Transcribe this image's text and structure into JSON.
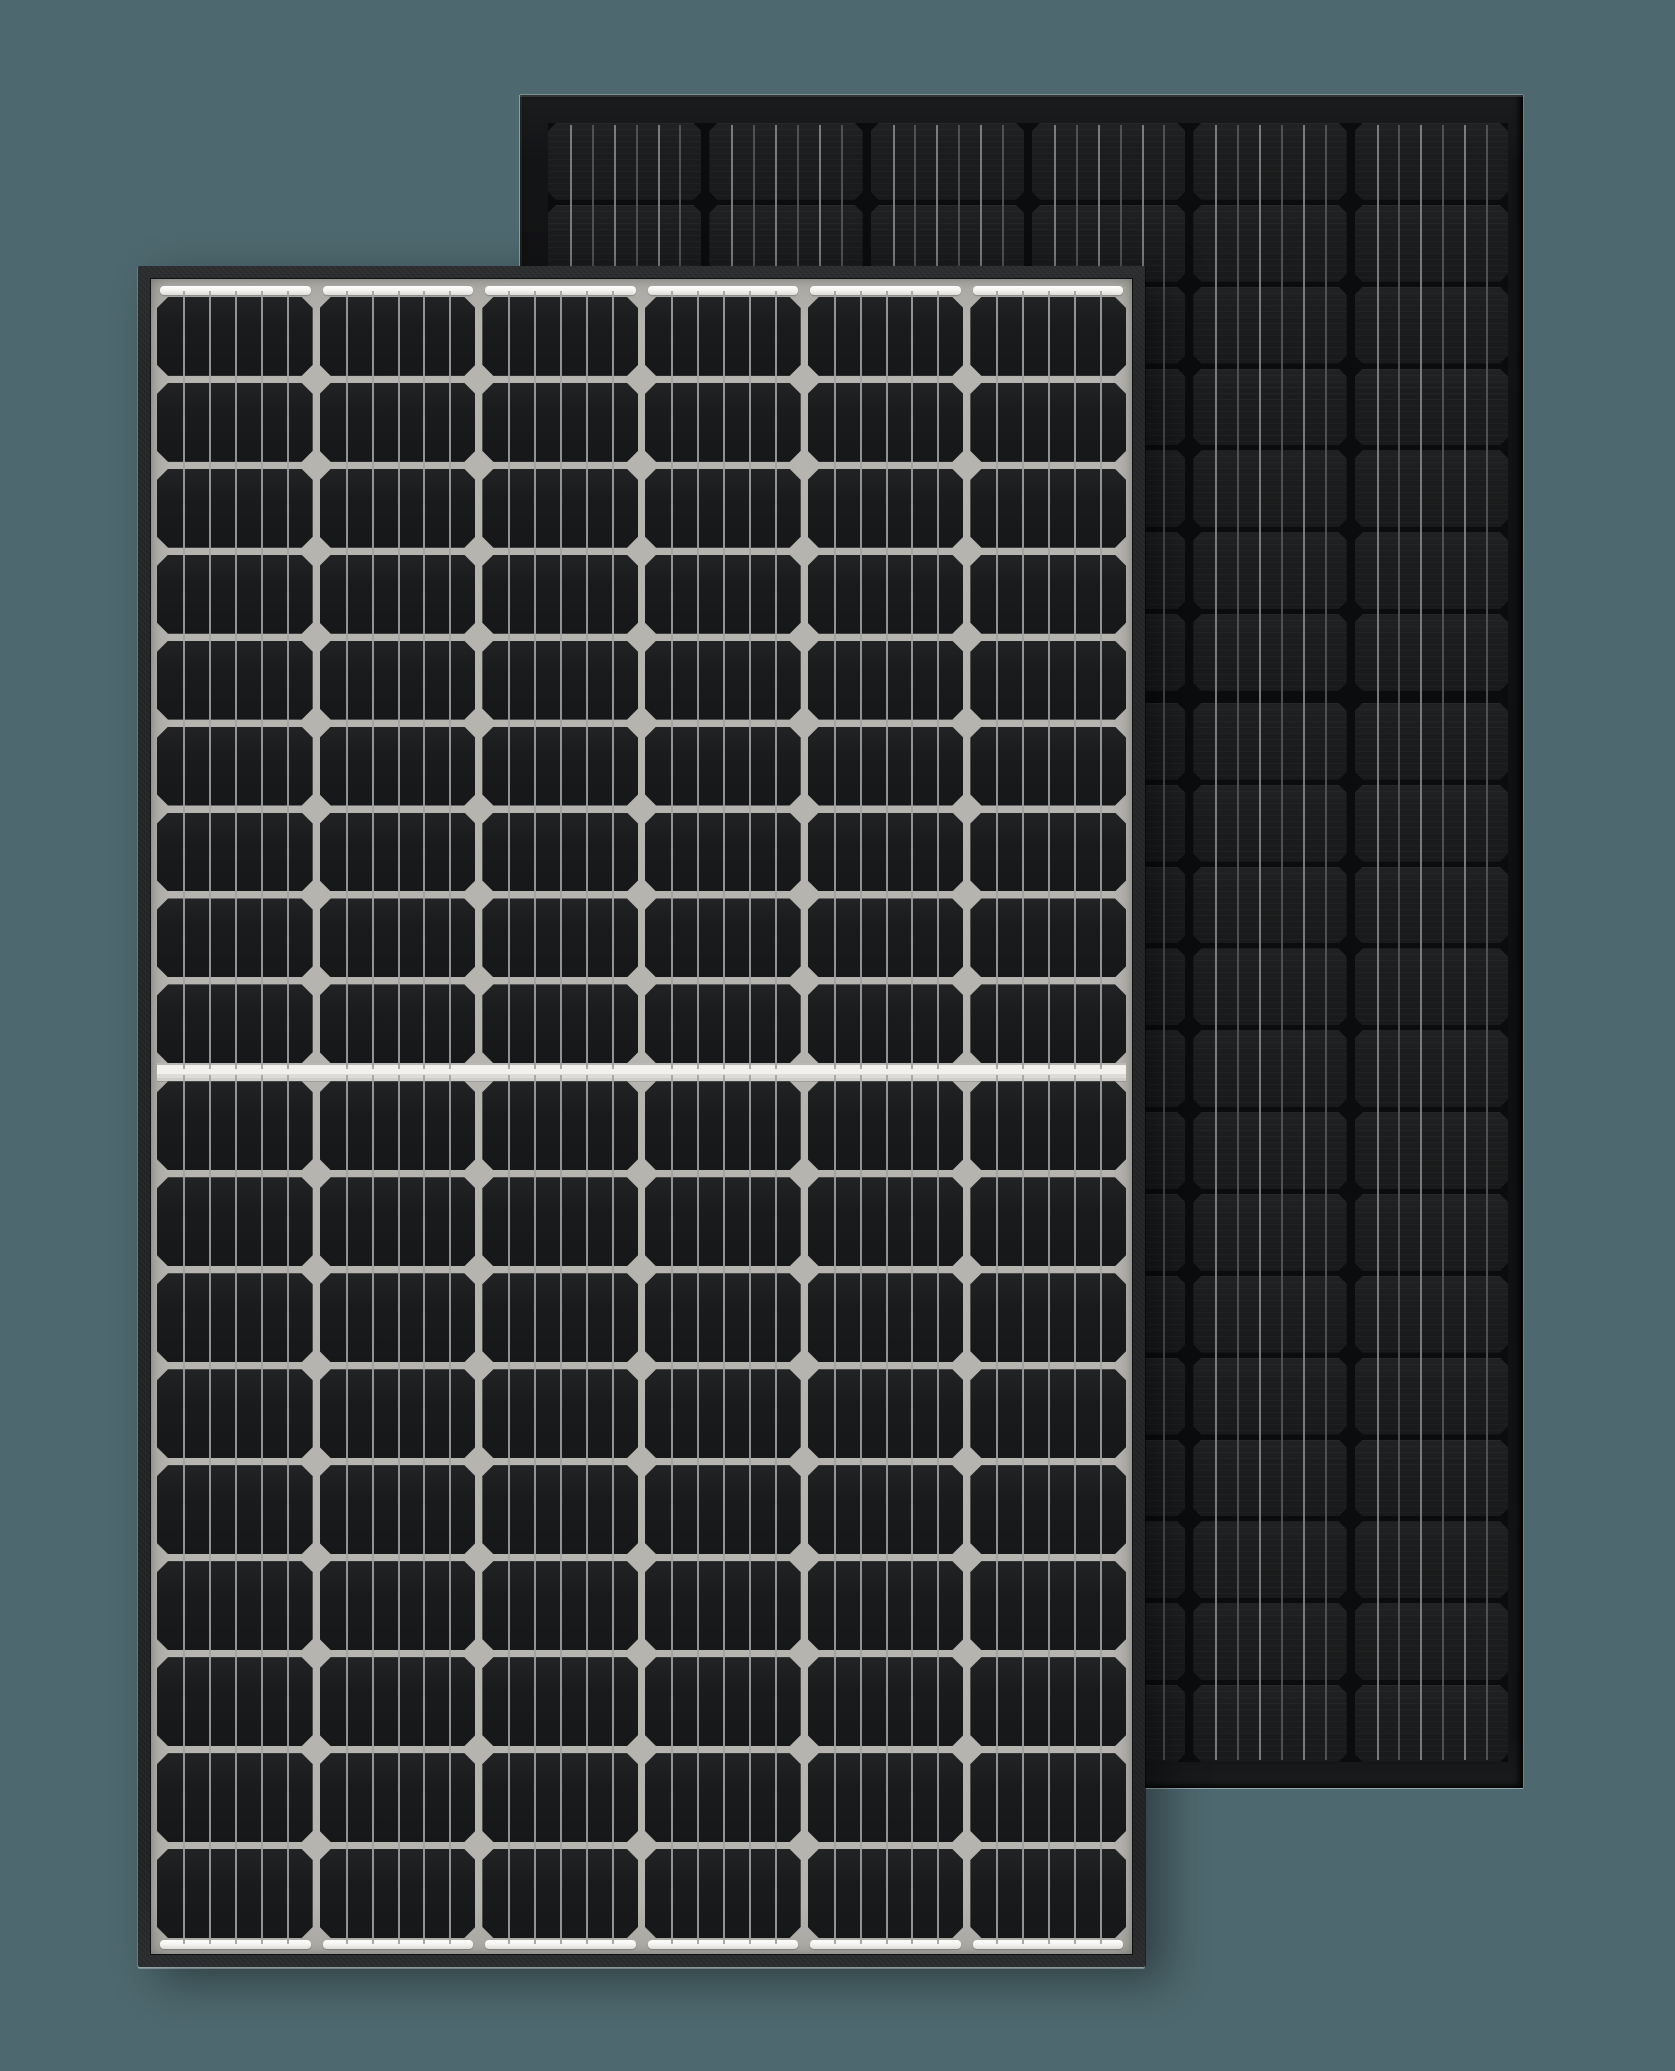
{
  "scene": {
    "description": "Two overlapping solar-panel product renders on a teal background",
    "background_color": "#4d686e"
  },
  "background_panel": {
    "name": "all-black solar panel (rear)",
    "columns": 6,
    "rows": 20,
    "seam_after_row": 7,
    "busbars_per_cell": 6,
    "frame_color": "#121314",
    "cell_color": "#1b1d1e",
    "gap_color": "#0b0c0d",
    "busbar_colors": [
      "#878d8f",
      "#565c5e"
    ],
    "geometry": {
      "left": 520,
      "top": 95,
      "width": 1003,
      "height": 1693
    }
  },
  "foreground_panel": {
    "name": "black-frame white-backsheet solar panel (front)",
    "columns": 6,
    "rows_top": 9,
    "rows_bottom": 9,
    "busbars_per_cell": 5,
    "frame_color": "#232527",
    "backsheet_color": "#d7d6d3",
    "cell_color": "#1a1b1d",
    "busbar_color": "#9fa1a3",
    "bus_strip_color": "#f2f1ee",
    "divider_color": "#f2f1ee",
    "geometry": {
      "left": 138,
      "top": 266,
      "width": 1007,
      "height": 1701
    }
  }
}
